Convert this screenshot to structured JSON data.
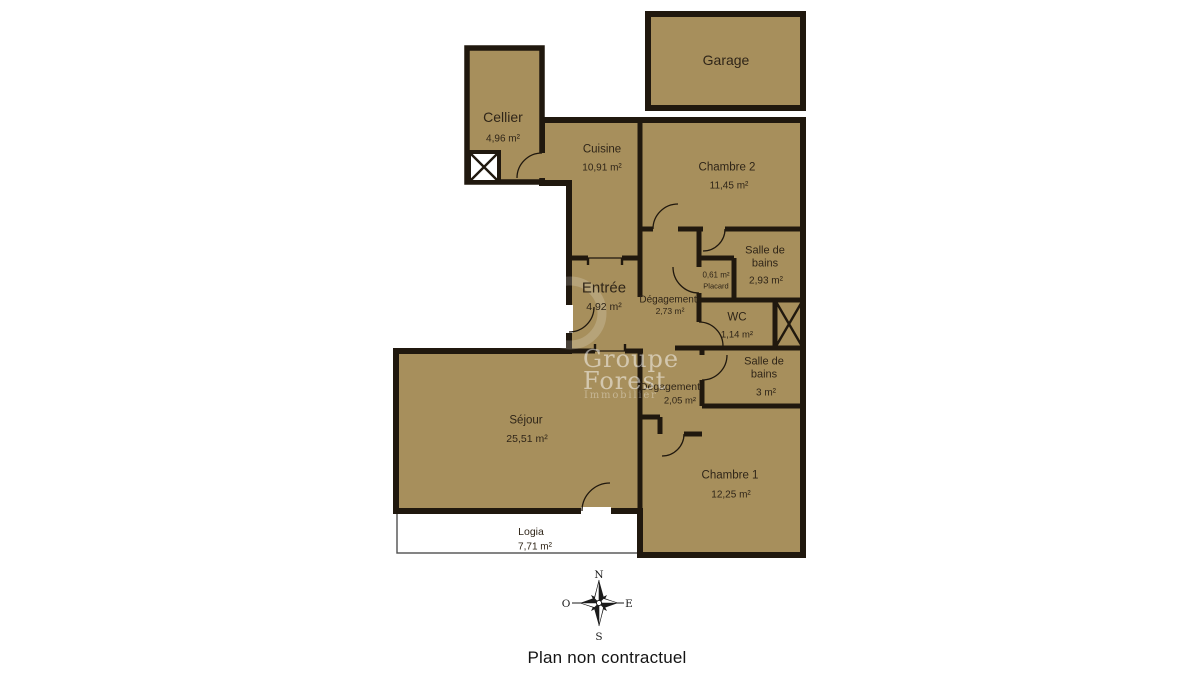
{
  "title": "Plan non contractuel",
  "rooms": {
    "garage": {
      "name": "Garage"
    },
    "cellier": {
      "name": "Cellier",
      "area": "4,96 m²"
    },
    "cuisine": {
      "name": "Cuisine",
      "area": "10,91 m²"
    },
    "chambre2": {
      "name": "Chambre 2",
      "area": "11,45 m²"
    },
    "sdb1": {
      "name": "Salle de bains",
      "area": "2,93 m²"
    },
    "placard": {
      "name": "Placard",
      "area": "0,61 m²"
    },
    "entree": {
      "name": "Entrée",
      "area": "4,92 m²"
    },
    "degagement1": {
      "name": "Dégagement",
      "area": "2,73 m²"
    },
    "wc": {
      "name": "WC",
      "area": "1,14 m²"
    },
    "sdb2": {
      "name": "Salle de bains",
      "area": "3 m²"
    },
    "degagement2": {
      "name": "Dégagement",
      "area": "2,05 m²"
    },
    "sejour": {
      "name": "Séjour",
      "area": "25,51 m²"
    },
    "chambre1": {
      "name": "Chambre 1",
      "area": "12,25 m²"
    },
    "logia": {
      "name": "Logia",
      "area": "7,71 m²"
    }
  },
  "compass": {
    "north": "N",
    "south": "S",
    "east": "E",
    "west": "O"
  },
  "watermark": {
    "line1": "Groupe",
    "line2": "Forest",
    "subtitle": "Immobilier"
  },
  "footer": "Plan non contractuel",
  "colors": {
    "floor": "#A78F5C",
    "wall": "#20180E",
    "background": "#FFFFFF"
  }
}
